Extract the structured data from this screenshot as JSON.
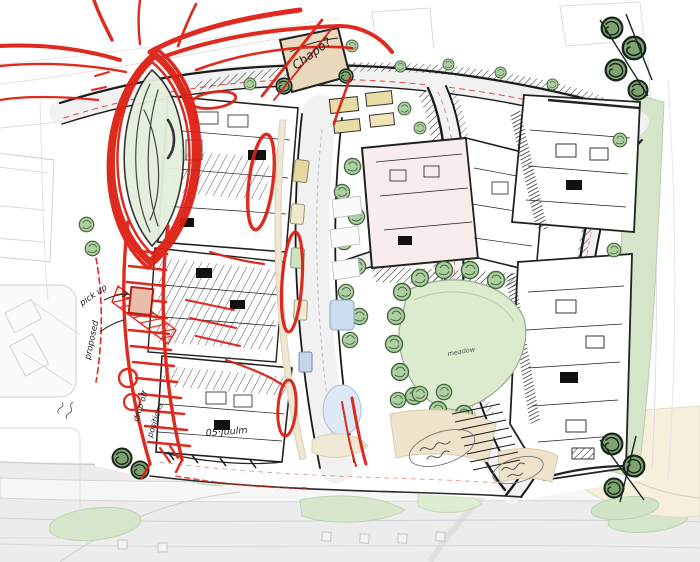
{
  "document": {
    "kind": "hand-drawn architectural masterplan sketch",
    "description": "Urban site plan with black ink building plans, green landscape, and red pen design markups (roundabout oval, circulation corridor, parking highlights)"
  },
  "palette": {
    "red_ink": "#dd1f14",
    "black_ink": "#1a1a1a",
    "lawn_green": "#dcebcd",
    "tree_green": "#aecfa4",
    "dark_tree_green": "#7fa271",
    "verge_green": "#d4e5c9",
    "beige": "#efe3cb",
    "pink_building": "#f8ecec",
    "water_blue": "#cdddf0",
    "context_grey": "#ebebeb",
    "paper": "#ffffff"
  },
  "annotations": {
    "chapel": {
      "text": "Chapo?",
      "ink": "black"
    },
    "pickup": {
      "text": "pick up",
      "ink": "black"
    },
    "proposed": {
      "text": "proposed",
      "ink": "black"
    },
    "dropoff": {
      "text": "drop off",
      "ink": "black"
    },
    "positions": {
      "text": "positions",
      "ink": "black"
    },
    "osjuulm": {
      "text": "05·Juulm",
      "ink": "black"
    },
    "meadow": {
      "text": "meadow",
      "ink": "black"
    }
  },
  "regions": [
    "red-roundabout-oval",
    "red-transit-corridor",
    "red-parking-highlights",
    "west-building-block",
    "west-parking-rows",
    "west-lower-block",
    "central-pink-building",
    "east-block-north",
    "east-block-south",
    "central-boulevard",
    "sweeping-road-west",
    "sweeping-road-east",
    "central-park-lawn",
    "right-green-verge",
    "chapel-block",
    "context-roads-south",
    "context-buildings-west"
  ]
}
